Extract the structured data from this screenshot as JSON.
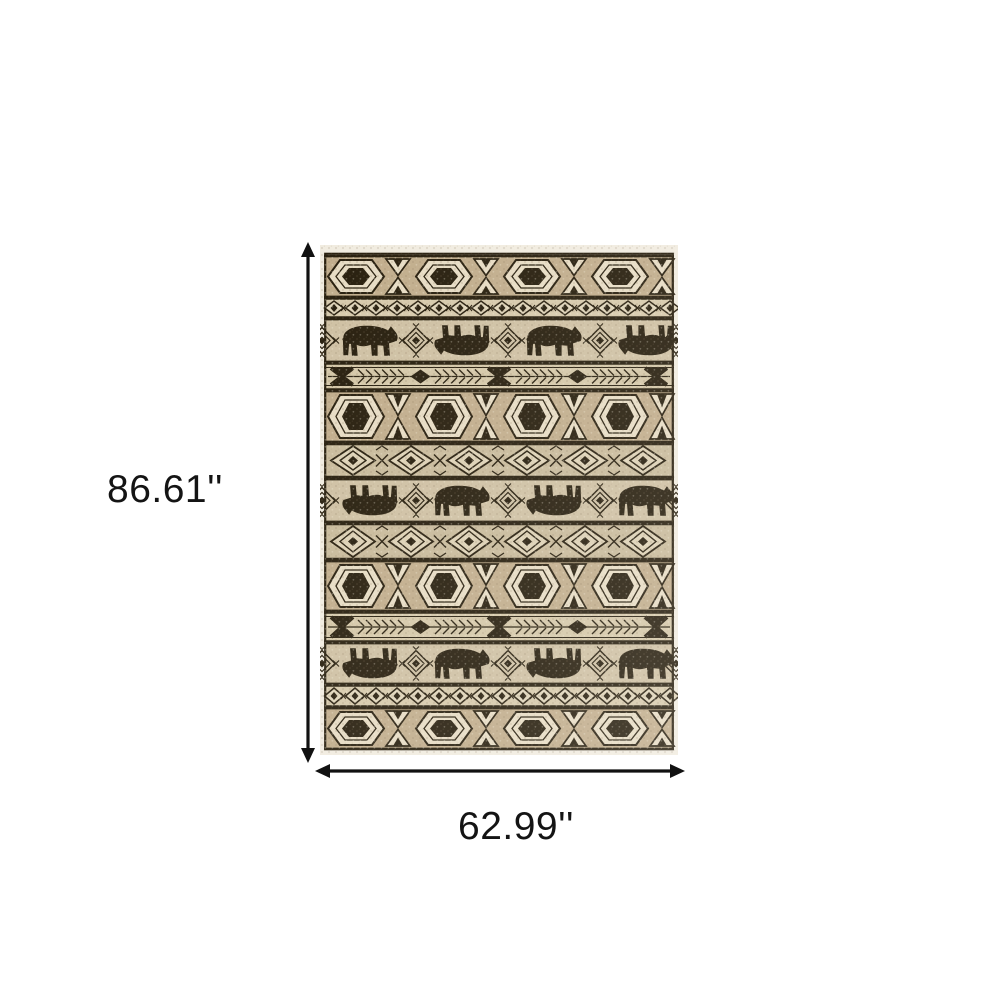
{
  "diagram": {
    "title": "Rug dimension diagram",
    "height_label": "86.61''",
    "width_label": "62.99''"
  },
  "arrows": {
    "color": "#111111"
  },
  "rug": {
    "description": "Beige and black southwestern lodge style area rug with bear silhouettes and geometric tribal bands",
    "colors": {
      "fringe": "#f1ece0",
      "dark": "#29200f",
      "light": "#e7dcc4",
      "hex_bg": "#c2ae8d",
      "chain_bg": "#d7caac",
      "bears_bg": "#cfc1a4",
      "feather_bg": "#d5c8a9",
      "diamond_bg": "#c9bb9c",
      "diamond_fill": "#ddd1b5"
    },
    "bands": [
      {
        "type": "hex",
        "height": 43
      },
      {
        "type": "chain",
        "height": 20
      },
      {
        "type": "bears",
        "height": 45,
        "orientation": "NFNF"
      },
      {
        "type": "feather",
        "height": 27
      },
      {
        "type": "hex",
        "height": 53
      },
      {
        "type": "diamond",
        "height": 35
      },
      {
        "type": "bears",
        "height": 45,
        "orientation": "FNFN"
      },
      {
        "type": "diamond",
        "height": 37
      },
      {
        "type": "hex",
        "height": 52
      },
      {
        "type": "feather",
        "height": 30
      },
      {
        "type": "bears",
        "height": 43,
        "orientation": "FNFN"
      },
      {
        "type": "chain",
        "height": 22
      },
      {
        "type": "hex",
        "height": 43
      }
    ]
  }
}
